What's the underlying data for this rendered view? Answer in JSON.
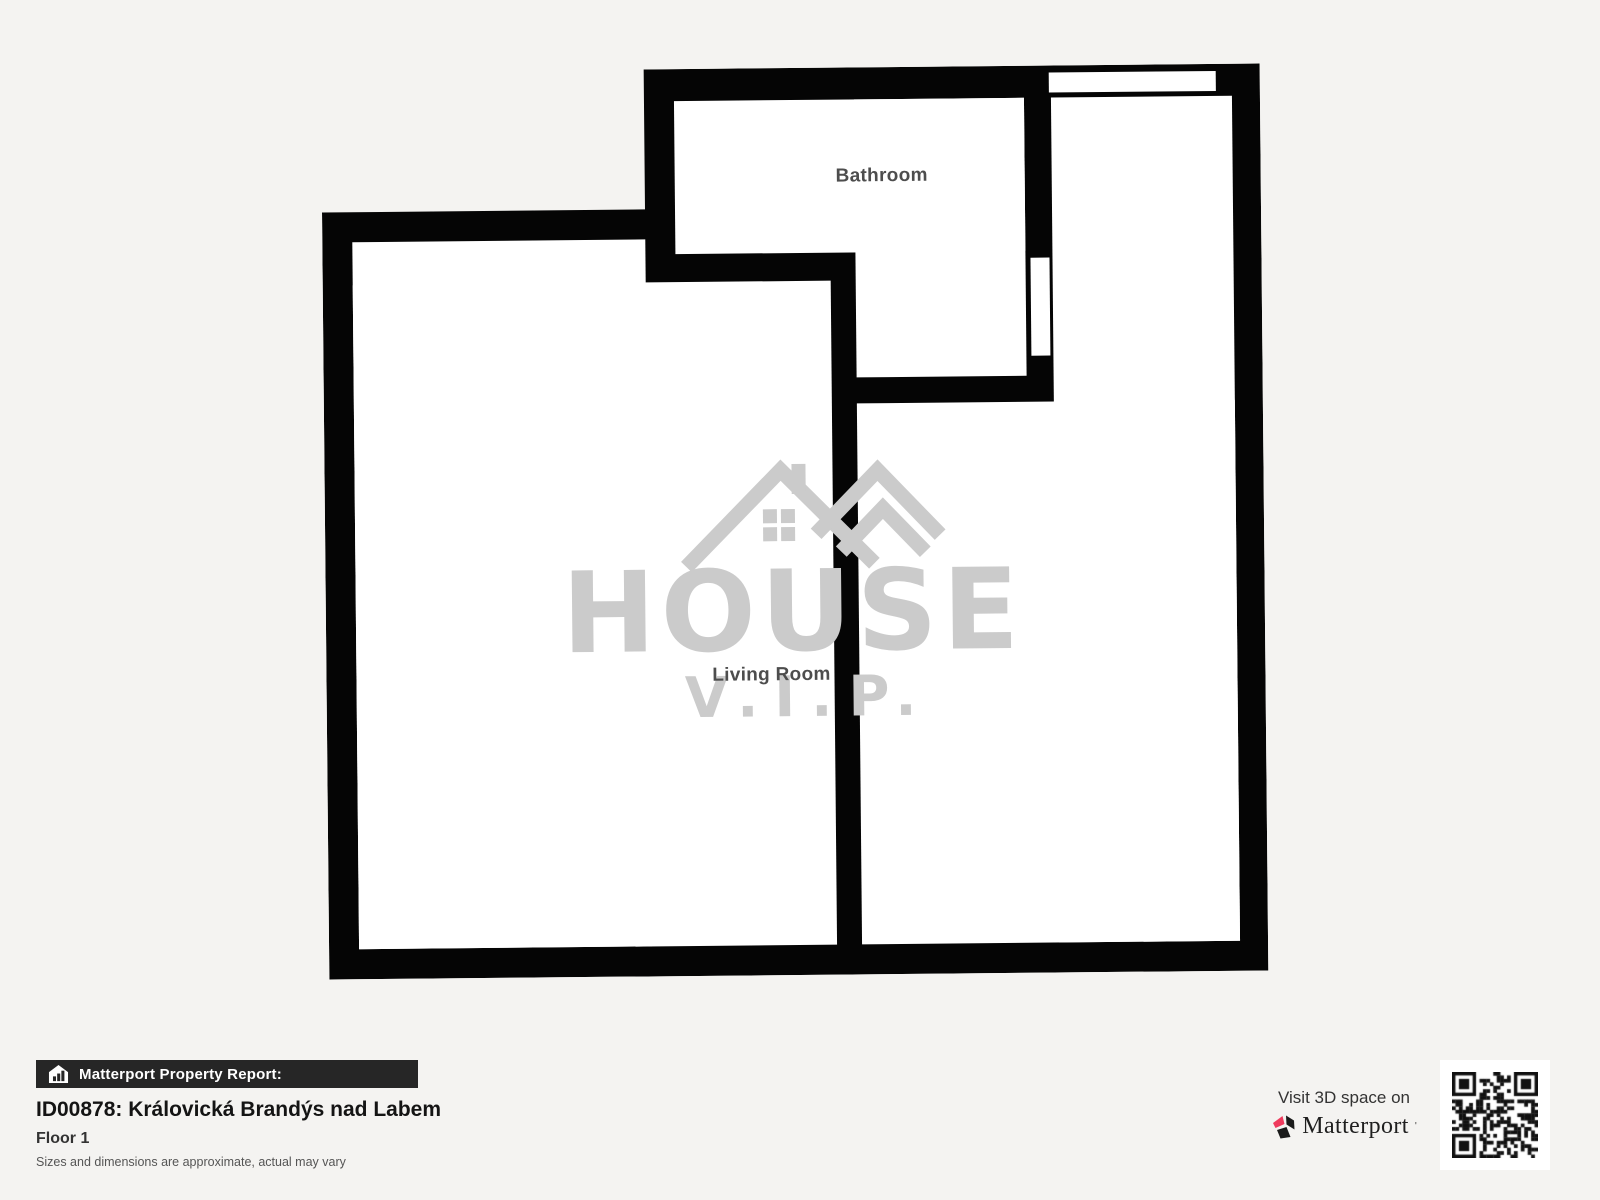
{
  "plan": {
    "rooms": [
      {
        "label": "Bathroom"
      },
      {
        "label": "Living Room"
      }
    ],
    "watermark": {
      "title": "HOUSE",
      "subtitle": "V.I.P."
    }
  },
  "footer": {
    "badge": "Matterport Property Report:",
    "property_title": "ID00878: Královická Brandýs nad Labem",
    "floor_label": "Floor 1",
    "disclaimer": "Sizes and dimensions are approximate, actual may vary"
  },
  "cta": {
    "visit_label": "Visit 3D space on",
    "brand_name": "Matterport",
    "trademark": "'"
  },
  "colors": {
    "wall": "#050505",
    "background": "#f4f3f1",
    "watermark_gray": "#cbcbcb",
    "bar_bg": "#262626",
    "accent_pink": "#ef3b5d"
  }
}
